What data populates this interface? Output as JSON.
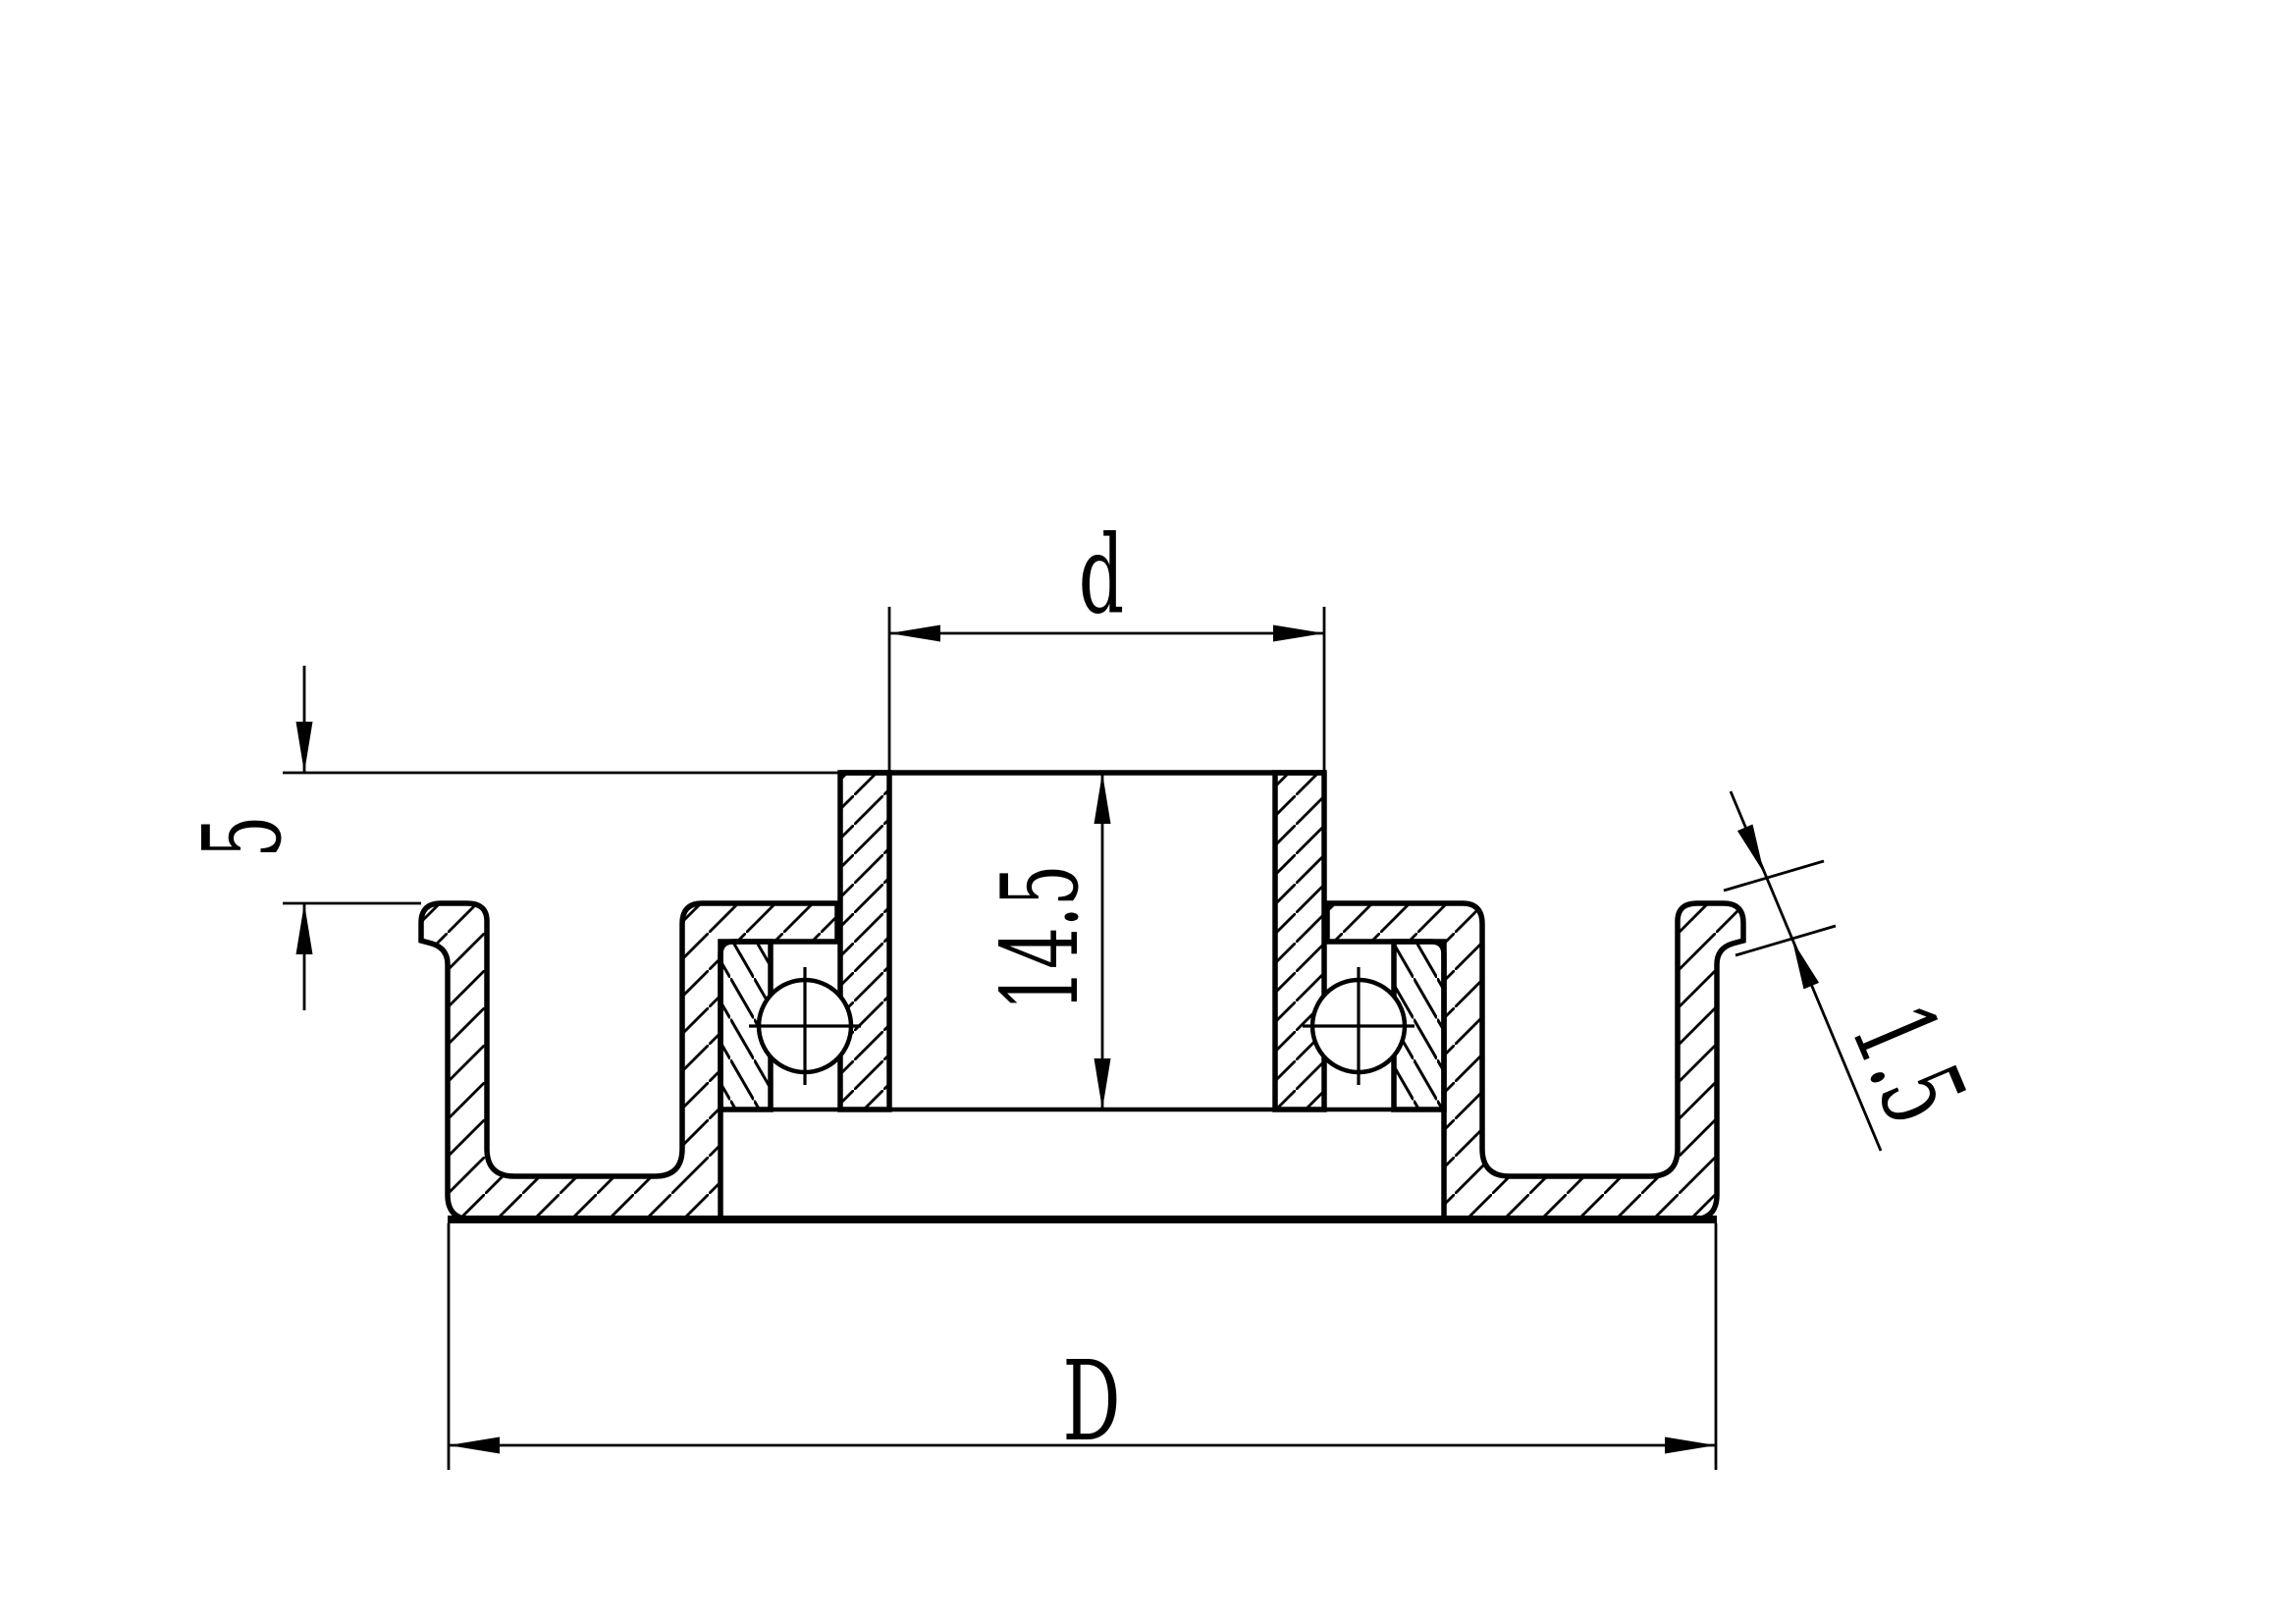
{
  "drawing": {
    "background_color": "#ffffff",
    "line_color": "#000000",
    "type_note": "engineering section drawing of flanged pulley with ball bearings",
    "dimensions": {
      "bore_diameter": {
        "label": "d"
      },
      "hub_protrusion": {
        "label": "5"
      },
      "hub_length": {
        "label": "14.5"
      },
      "flange_lip_thickness": {
        "label": "1.5"
      },
      "outer_diameter": {
        "label": "D"
      }
    }
  }
}
